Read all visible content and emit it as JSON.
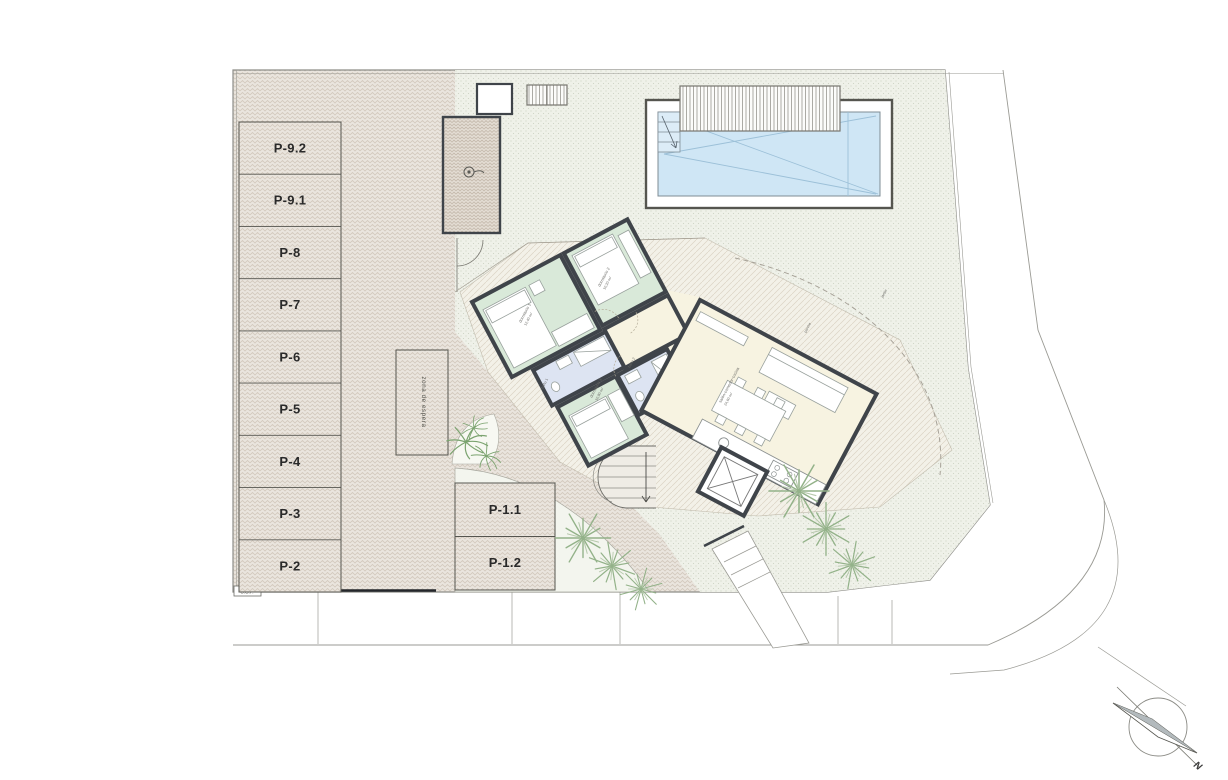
{
  "plan_type": "site-floor-plan",
  "labels": {
    "parking_left": [
      "P-9.2",
      "P-9.1",
      "P-8",
      "P-7",
      "P-6",
      "P-5",
      "P-4",
      "P-3",
      "P-2"
    ],
    "parking_island": [
      "P-1.1",
      "P-1.2"
    ],
    "waiting_zone": "zona de espera",
    "utility_box": "C.G.P.",
    "compass_north": "N"
  },
  "rooms": {
    "bedroom1_name": "dormitorio 1",
    "bedroom1_area": "12,40 m²",
    "bedroom2_name": "dormitorio 2",
    "bedroom2_area": "10,20 m²",
    "bedroom3_name": "dormitorio 3",
    "bedroom3_area": "10,90 m²",
    "bath1_name": "baño 1",
    "bath1_area": "4,20 m²",
    "bath2_name": "baño 2",
    "bath2_area": "3,80 m²",
    "living_name": "salón-comedor-cocina",
    "living_area": "24,60 m²",
    "porch_name": "porche",
    "porch_area": "12,00 m²",
    "garden_name": "jardín",
    "garden_area": "jardín"
  },
  "colors": {
    "wall": "#3f444a",
    "bedroom_green": "#d9e9d9",
    "bath_blue": "#dde4f2",
    "living_cream": "#f7f3e1",
    "pool_water": "#cfe6f5",
    "paving_base": "#eae5de",
    "garden_base": "#eff1e9",
    "palm_green": "#93b289",
    "boundary_gray": "#9a9a94"
  }
}
